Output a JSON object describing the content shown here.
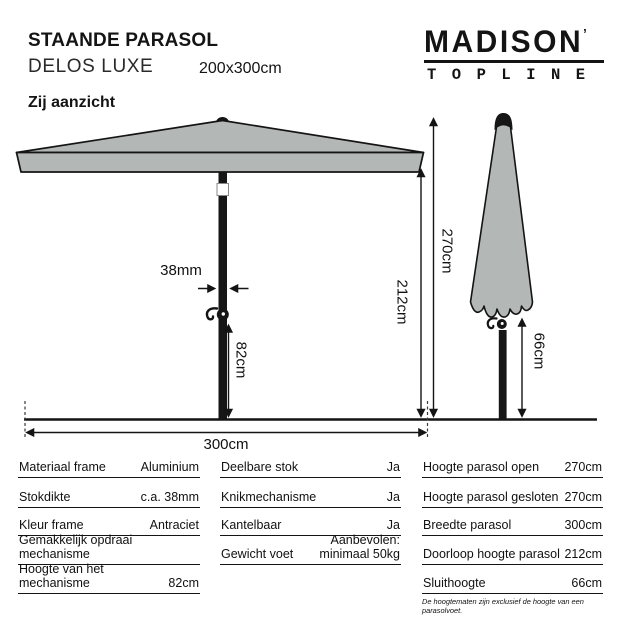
{
  "header": {
    "title": "STAANDE PARASOL",
    "model": "DELOS LUXE",
    "dimensions": "200x300cm",
    "logo_brand": "MADISON",
    "logo_mark": "’",
    "logo_sub": "TOPLINE"
  },
  "section": {
    "title": "Zij aanzicht"
  },
  "diagram": {
    "pole_diameter_label": "38mm",
    "mechanism_height_label": "82cm",
    "doorloop_height_label": "212cm",
    "open_height_label": "270cm",
    "width_label": "300cm",
    "sluithoogte_label": "66cm"
  },
  "colors": {
    "canopy": "#b3b7b5",
    "frame": "#161616"
  },
  "table": {
    "col1": [
      {
        "label": "Materiaal frame",
        "value": "Aluminium"
      },
      {
        "label": "Stokdikte",
        "value": "c.a. 38mm"
      },
      {
        "label": "Kleur frame",
        "value": "Antraciet"
      },
      {
        "label": "Gemakkelijk opdraai mechanisme",
        "value": ""
      },
      {
        "label": "Hoogte van het mechanisme",
        "value": "82cm"
      }
    ],
    "col2": [
      {
        "label": "Deelbare stok",
        "value": "Ja"
      },
      {
        "label": "Knikmechanisme",
        "value": "Ja"
      },
      {
        "label": "Kantelbaar",
        "value": "Ja"
      },
      {
        "label": "Gewicht voet",
        "value_line1": "Aanbevolen:",
        "value_line2": "minimaal 50kg"
      }
    ],
    "col3": [
      {
        "label": "Hoogte parasol open",
        "value": "270cm"
      },
      {
        "label": "Hoogte parasol gesloten",
        "value": "270cm"
      },
      {
        "label": "Breedte parasol",
        "value": "300cm"
      },
      {
        "label": "Doorloop hoogte parasol",
        "value": "212cm"
      },
      {
        "label": "Sluithoogte",
        "value": "66cm"
      }
    ],
    "footnote": "De hoogtematen zijn exclusief de hoogte van een parasolvoet."
  }
}
